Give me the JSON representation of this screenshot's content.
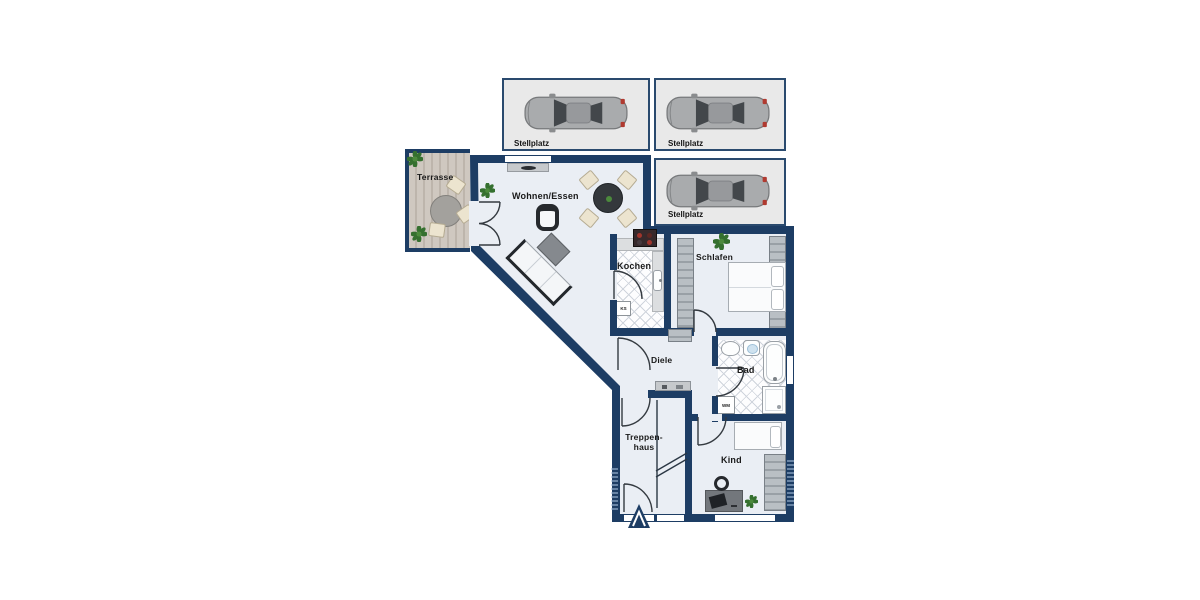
{
  "plan": {
    "parking": {
      "labels": [
        "Stellplatz",
        "Stellplatz",
        "Stellplatz"
      ]
    },
    "rooms": {
      "terrasse": "Terrasse",
      "wohnen_essen": "Wohnen/Essen",
      "kochen": "Kochen",
      "schlafen": "Schlafen",
      "diele": "Diele",
      "bad": "Bad",
      "treppenhaus_line1": "Treppen-",
      "treppenhaus_line2": "haus",
      "kind": "Kind"
    },
    "appliances": {
      "fridge": "KS",
      "washing_machine": "WM"
    },
    "colors": {
      "wall": "#1d3d64",
      "floor": "#eaeef4",
      "parking_bg": "#e9e9e9",
      "deck_wood": "#c6beb4",
      "wardrobe": "#a8aeb3",
      "furniture_dark": "#26292d",
      "chair_cream": "#ece4cf",
      "plant_green": "#3a7a35",
      "taillight_red": "#b03a30",
      "tile_line": "#cfd4dc"
    }
  }
}
